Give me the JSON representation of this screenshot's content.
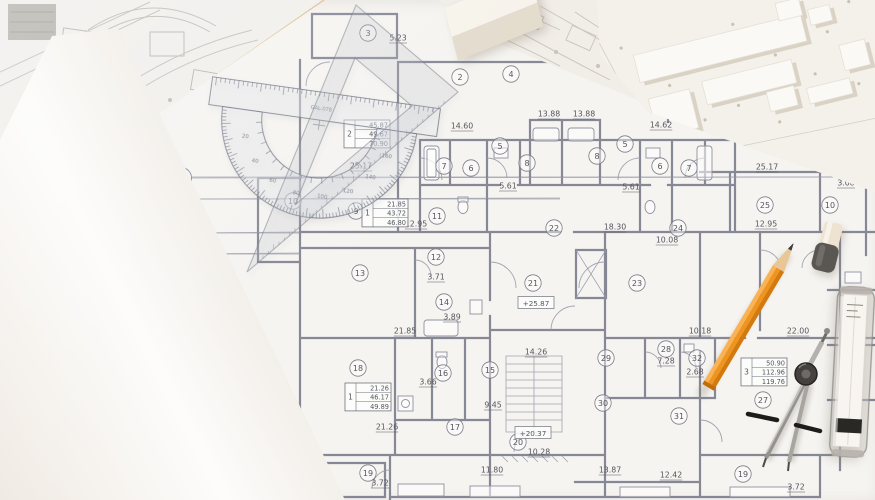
{
  "scene": {
    "title": "Architectural floor plan blueprint on drafting table with tools and scale model",
    "colors": {
      "paper_bg": "#f1efec",
      "blueprint_paper": "#f6f4f1",
      "plan_line": "#8f92a0",
      "plan_wall": "#6d7080",
      "pencil_orange": "#ef941f",
      "pencil_wood": "#e9c695",
      "wood_strip_tan": "#c9a26b",
      "eraser_top": "#eee3d0",
      "eraser_bottom": "#5a5651",
      "compass_metal": "#a7a39e",
      "compass_knob": "#45413e",
      "model_paper": "#f4f0ea",
      "roll_highlight": "#fffffe",
      "roll_shade": "#e4ded5"
    }
  },
  "plan": {
    "axis_labels": [
      {
        "label": "E",
        "x": 181,
        "y": 178,
        "line_to": 868
      },
      {
        "label": "",
        "x": 179,
        "y": 199,
        "line_to": 560
      },
      {
        "label": "",
        "x": 180,
        "y": 233,
        "line_to": 299
      },
      {
        "label": "",
        "x": 179,
        "y": 254,
        "line_to": 299
      }
    ],
    "rooms": [
      {
        "n": "3",
        "x": 368,
        "y": 33
      },
      {
        "n": "2",
        "x": 460,
        "y": 77
      },
      {
        "n": "4",
        "x": 511,
        "y": 74
      },
      {
        "n": "7",
        "x": 444,
        "y": 166
      },
      {
        "n": "6",
        "x": 471,
        "y": 168
      },
      {
        "n": "5",
        "x": 500,
        "y": 146
      },
      {
        "n": "8",
        "x": 527,
        "y": 163
      },
      {
        "n": "8",
        "x": 597,
        "y": 156
      },
      {
        "n": "5",
        "x": 625,
        "y": 144
      },
      {
        "n": "6",
        "x": 660,
        "y": 166
      },
      {
        "n": "7",
        "x": 689,
        "y": 168
      },
      {
        "n": "9",
        "x": 356,
        "y": 211
      },
      {
        "n": "10",
        "x": 293,
        "y": 201
      },
      {
        "n": "11",
        "x": 437,
        "y": 216
      },
      {
        "n": "12",
        "x": 436,
        "y": 257
      },
      {
        "n": "13",
        "x": 360,
        "y": 273
      },
      {
        "n": "14",
        "x": 444,
        "y": 302
      },
      {
        "n": "15",
        "x": 490,
        "y": 370
      },
      {
        "n": "16",
        "x": 443,
        "y": 373
      },
      {
        "n": "17",
        "x": 455,
        "y": 427
      },
      {
        "n": "18",
        "x": 358,
        "y": 368
      },
      {
        "n": "19",
        "x": 368,
        "y": 473
      },
      {
        "n": "20",
        "x": 518,
        "y": 442
      },
      {
        "n": "21",
        "x": 533,
        "y": 283
      },
      {
        "n": "22",
        "x": 554,
        "y": 228
      },
      {
        "n": "23",
        "x": 637,
        "y": 283
      },
      {
        "n": "24",
        "x": 678,
        "y": 228
      },
      {
        "n": "25",
        "x": 765,
        "y": 205
      },
      {
        "n": "10",
        "x": 830,
        "y": 205
      },
      {
        "n": "27",
        "x": 763,
        "y": 400
      },
      {
        "n": "28",
        "x": 666,
        "y": 349
      },
      {
        "n": "29",
        "x": 606,
        "y": 358
      },
      {
        "n": "30",
        "x": 603,
        "y": 403
      },
      {
        "n": "31",
        "x": 679,
        "y": 416
      },
      {
        "n": "32",
        "x": 697,
        "y": 358
      },
      {
        "n": "19",
        "x": 743,
        "y": 474
      }
    ],
    "dims": [
      {
        "v": "5.23",
        "x": 398,
        "y": 38
      },
      {
        "v": "14.60",
        "x": 462,
        "y": 126
      },
      {
        "v": "13.88",
        "x": 549,
        "y": 114
      },
      {
        "v": "13.88",
        "x": 584,
        "y": 114
      },
      {
        "v": "14.62",
        "x": 661,
        "y": 125
      },
      {
        "v": "5.61",
        "x": 508,
        "y": 186
      },
      {
        "v": "5.61",
        "x": 631,
        "y": 187
      },
      {
        "v": "25.17",
        "x": 361,
        "y": 166
      },
      {
        "v": "25.17",
        "x": 767,
        "y": 167
      },
      {
        "v": "3.08",
        "x": 846,
        "y": 183
      },
      {
        "v": "12.95",
        "x": 416,
        "y": 224
      },
      {
        "v": "12.95",
        "x": 766,
        "y": 224
      },
      {
        "v": "18.30",
        "x": 615,
        "y": 227
      },
      {
        "v": "10.08",
        "x": 667,
        "y": 240
      },
      {
        "v": "3.71",
        "x": 436,
        "y": 277
      },
      {
        "v": "3.89",
        "x": 452,
        "y": 317
      },
      {
        "v": "21.85",
        "x": 405,
        "y": 331
      },
      {
        "v": "14.26",
        "x": 536,
        "y": 352
      },
      {
        "v": "10.18",
        "x": 700,
        "y": 331
      },
      {
        "v": "22.00",
        "x": 798,
        "y": 331
      },
      {
        "v": "7.28",
        "x": 666,
        "y": 361
      },
      {
        "v": "2.68",
        "x": 695,
        "y": 372
      },
      {
        "v": "3.66",
        "x": 428,
        "y": 382
      },
      {
        "v": "9.45",
        "x": 493,
        "y": 405
      },
      {
        "v": "21.26",
        "x": 387,
        "y": 427
      },
      {
        "v": "10.28",
        "x": 539,
        "y": 452
      },
      {
        "v": "11.80",
        "x": 492,
        "y": 470
      },
      {
        "v": "13.87",
        "x": 610,
        "y": 470
      },
      {
        "v": "12.42",
        "x": 671,
        "y": 475
      },
      {
        "v": "3.72",
        "x": 380,
        "y": 483
      },
      {
        "v": "3.72",
        "x": 796,
        "y": 487
      }
    ],
    "unit_boxes": [
      {
        "unit": "2",
        "rows": [
          "45.87",
          "49.67",
          "70.90"
        ],
        "x": 344,
        "y": 120
      },
      {
        "unit": "1",
        "rows": [
          "21.85",
          "43.72",
          "46.80"
        ],
        "x": 362,
        "y": 199
      },
      {
        "unit": "1",
        "rows": [
          "21.26",
          "46.17",
          "49.89"
        ],
        "x": 345,
        "y": 383
      },
      {
        "unit": "3",
        "rows": [
          "50.90",
          "112.96",
          "119.76"
        ],
        "x": 741,
        "y": 358
      }
    ],
    "elevations": [
      {
        "v": "+25.87",
        "x": 536,
        "y": 303
      },
      {
        "v": "+20.37",
        "x": 533,
        "y": 433
      }
    ]
  },
  "tools": {
    "protractor": {
      "brand": "GAL-078",
      "degree_labels": [
        20,
        40,
        60,
        80,
        100,
        120,
        140,
        160
      ]
    },
    "triangle": {
      "type": "set-square"
    },
    "pencil": {
      "type": "drafting pencil"
    },
    "compass": {
      "type": "divider compass"
    },
    "eraser": {
      "type": "cap eraser"
    },
    "tube": {
      "type": "lead case"
    }
  }
}
